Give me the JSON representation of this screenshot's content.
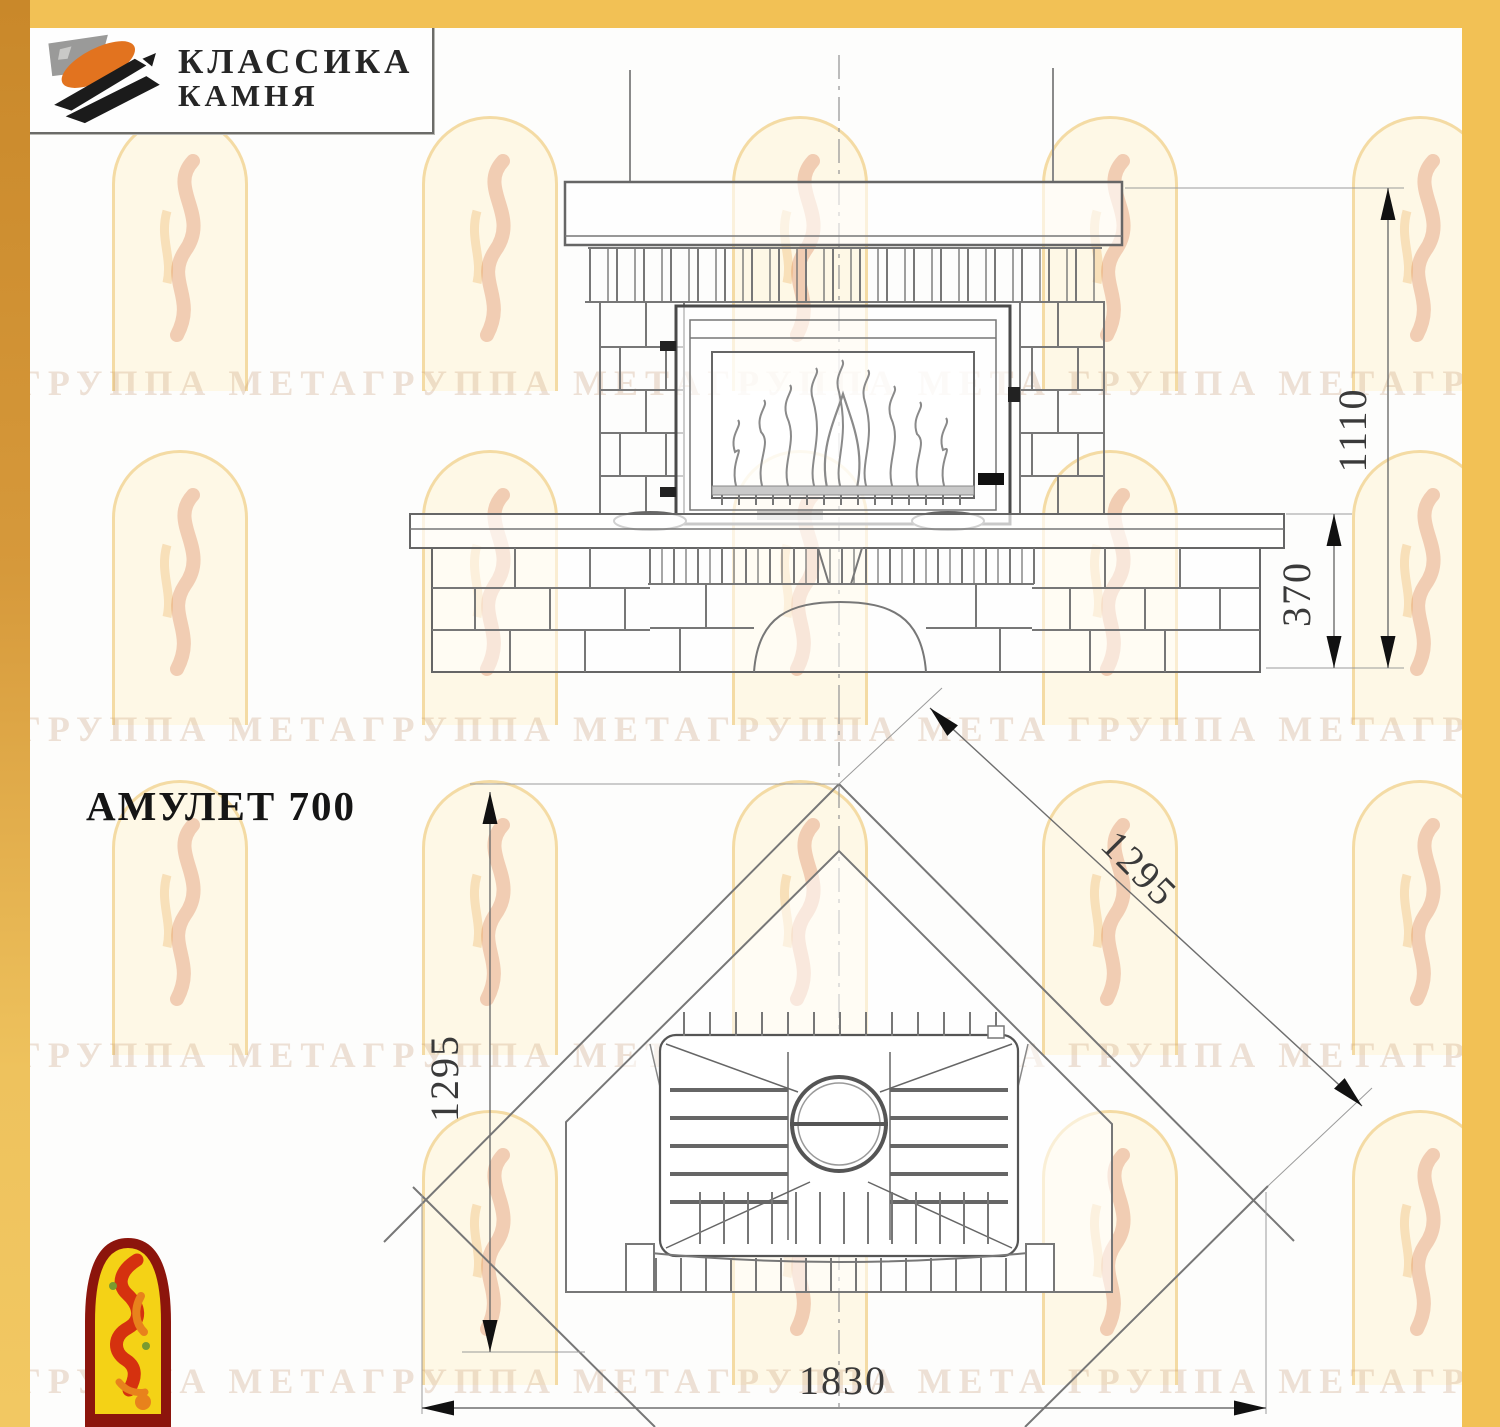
{
  "branding": {
    "name_line1": "КЛАССИКА",
    "name_line2": "КАМНЯ"
  },
  "model_label": "АМУЛЕТ 700",
  "dimensions": {
    "overall_height_mm": "1110",
    "bench_height_mm": "370",
    "overall_width_mm": "1830",
    "wall_side_left_mm": "1295",
    "wall_side_right_mm": "1295"
  },
  "watermark": {
    "phrase": "ГРУППА МЕТАГРУППА МЕТАГРУППА МЕТА"
  },
  "colors": {
    "frame_gold": "#F2C155",
    "frame_gold_dark": "#D1912F",
    "drawing_line": "#777777",
    "dim_text": "#3A3A3A",
    "corner_logo_red": "#8C150C",
    "corner_logo_yellow": "#F4D216",
    "corner_logo_flame": "#D5310F",
    "corner_logo_orange": "#E8821C",
    "brand_orange": "#E2731F"
  }
}
